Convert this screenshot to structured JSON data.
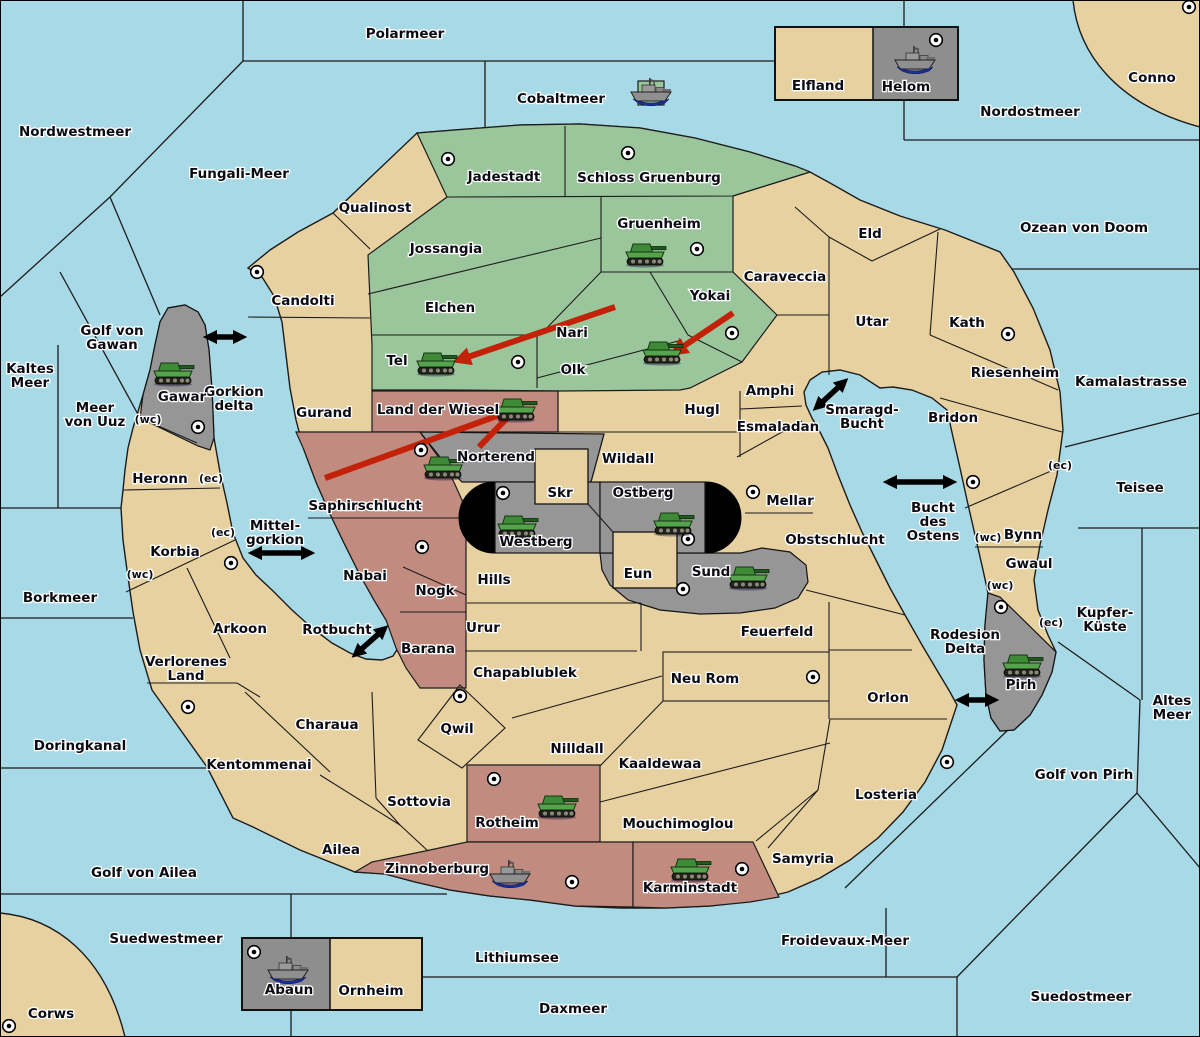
{
  "map": {
    "title": "Strategy war map",
    "colors": {
      "water": "#A8D9E6",
      "land": "#E8D1A0",
      "green_player": "#9BC69B",
      "red_player": "#C28B80",
      "gray_player": "#969696",
      "attack_arrow": "#C32208",
      "connection_arrow": "#000000"
    },
    "seas": [
      {
        "name": "Polarmeer",
        "x": 405,
        "y": 33
      },
      {
        "name": "Nordwestmeer",
        "x": 75,
        "y": 131
      },
      {
        "name": "Fungali-Meer",
        "x": 239,
        "y": 173
      },
      {
        "name": "Cobaltmeer",
        "x": 561,
        "y": 98
      },
      {
        "name": "Nordostmeer",
        "x": 1030,
        "y": 111
      },
      {
        "name": "Ozean von Doom",
        "x": 1084,
        "y": 227
      },
      {
        "name": "Kaltes Meer",
        "x": 30,
        "y": 375,
        "lines": [
          "Kaltes",
          "Meer"
        ]
      },
      {
        "name": "Golf von Gawan",
        "x": 112,
        "y": 337,
        "lines": [
          "Golf von",
          "Gawan"
        ]
      },
      {
        "name": "Meer von Uuz",
        "x": 95,
        "y": 414,
        "lines": [
          "Meer",
          "von Uuz"
        ]
      },
      {
        "name": "Gorkion delta",
        "x": 234,
        "y": 398,
        "lines": [
          "Gorkion",
          "delta"
        ]
      },
      {
        "name": "Kamalastrasse",
        "x": 1131,
        "y": 381
      },
      {
        "name": "Teisee",
        "x": 1140,
        "y": 487
      },
      {
        "name": "Borkmeer",
        "x": 60,
        "y": 597
      },
      {
        "name": "Mittel- gorkion",
        "x": 275,
        "y": 532,
        "lines": [
          "Mittel-",
          "gorkion"
        ]
      },
      {
        "name": "Rotbucht",
        "x": 337,
        "y": 629
      },
      {
        "name": "Smaragd-Bucht",
        "x": 862,
        "y": 416,
        "lines": [
          "Smaragd-",
          "Bucht"
        ]
      },
      {
        "name": "Bucht des Ostens",
        "x": 933,
        "y": 521,
        "lines": [
          "Bucht",
          "des",
          "Ostens"
        ]
      },
      {
        "name": "Kupfer-Küste",
        "x": 1105,
        "y": 619,
        "lines": [
          "Kupfer-",
          "Küste"
        ]
      },
      {
        "name": "Altes Meer",
        "x": 1172,
        "y": 707,
        "lines": [
          "Altes",
          "Meer"
        ]
      },
      {
        "name": "Rodesion Delta",
        "x": 965,
        "y": 641,
        "lines": [
          "Rodesion",
          "Delta"
        ]
      },
      {
        "name": "Golf von Pirh",
        "x": 1084,
        "y": 774
      },
      {
        "name": "Doringkanal",
        "x": 80,
        "y": 745
      },
      {
        "name": "Golf von Ailea",
        "x": 144,
        "y": 872
      },
      {
        "name": "Suedwestmeer",
        "x": 166,
        "y": 938
      },
      {
        "name": "Lithiumsee",
        "x": 517,
        "y": 957
      },
      {
        "name": "Daxmeer",
        "x": 573,
        "y": 1008
      },
      {
        "name": "Froidevaux-Meer",
        "x": 845,
        "y": 940
      },
      {
        "name": "Suedostmeer",
        "x": 1081,
        "y": 996
      }
    ],
    "territories": [
      {
        "name": "Jadestadt",
        "x": 504,
        "y": 176,
        "color": "green"
      },
      {
        "name": "Schloss Gruenburg",
        "x": 649,
        "y": 177,
        "color": "green"
      },
      {
        "name": "Gruenheim",
        "x": 659,
        "y": 223,
        "color": "green"
      },
      {
        "name": "Jossangia",
        "x": 446,
        "y": 248,
        "color": "green"
      },
      {
        "name": "Elchen",
        "x": 450,
        "y": 307,
        "color": "green"
      },
      {
        "name": "Nari",
        "x": 572,
        "y": 332,
        "color": "green"
      },
      {
        "name": "Yokai",
        "x": 710,
        "y": 295,
        "color": "green"
      },
      {
        "name": "Tel",
        "x": 397,
        "y": 360,
        "color": "green"
      },
      {
        "name": "Olk",
        "x": 573,
        "y": 369,
        "color": "green"
      },
      {
        "name": "Qualinost",
        "x": 375,
        "y": 207,
        "color": "tan"
      },
      {
        "name": "Candolti",
        "x": 303,
        "y": 300,
        "color": "tan"
      },
      {
        "name": "Gurand",
        "x": 324,
        "y": 412,
        "color": "tan"
      },
      {
        "name": "Caraveccia",
        "x": 785,
        "y": 276,
        "color": "tan"
      },
      {
        "name": "Eld",
        "x": 870,
        "y": 233,
        "color": "tan"
      },
      {
        "name": "Utar",
        "x": 872,
        "y": 321,
        "color": "tan"
      },
      {
        "name": "Kath",
        "x": 967,
        "y": 322,
        "color": "tan"
      },
      {
        "name": "Riesenheim",
        "x": 1015,
        "y": 372,
        "color": "tan"
      },
      {
        "name": "Bridon",
        "x": 953,
        "y": 417,
        "color": "tan"
      },
      {
        "name": "Amphi",
        "x": 770,
        "y": 390,
        "color": "tan"
      },
      {
        "name": "Esmaladan",
        "x": 778,
        "y": 426,
        "color": "tan"
      },
      {
        "name": "Hugl",
        "x": 702,
        "y": 409,
        "color": "tan"
      },
      {
        "name": "Wildall",
        "x": 628,
        "y": 458,
        "color": "tan"
      },
      {
        "name": "Mellar",
        "x": 790,
        "y": 500,
        "color": "tan"
      },
      {
        "name": "Obstschlucht",
        "x": 835,
        "y": 539,
        "color": "tan"
      },
      {
        "name": "Skr",
        "x": 560,
        "y": 492,
        "color": "tan"
      },
      {
        "name": "Eun",
        "x": 638,
        "y": 573,
        "color": "tan"
      },
      {
        "name": "Hills",
        "x": 494,
        "y": 579,
        "color": "tan"
      },
      {
        "name": "Urur",
        "x": 483,
        "y": 627,
        "color": "tan"
      },
      {
        "name": "Feuerfeld",
        "x": 777,
        "y": 631,
        "color": "tan"
      },
      {
        "name": "Neu Rom",
        "x": 705,
        "y": 678,
        "color": "tan"
      },
      {
        "name": "Chapablublek",
        "x": 525,
        "y": 672,
        "color": "tan"
      },
      {
        "name": "Qwil",
        "x": 457,
        "y": 728,
        "color": "tan"
      },
      {
        "name": "Nilldall",
        "x": 577,
        "y": 748,
        "color": "tan"
      },
      {
        "name": "Kaaldewaa",
        "x": 660,
        "y": 763,
        "color": "tan"
      },
      {
        "name": "Orlon",
        "x": 888,
        "y": 697,
        "color": "tan"
      },
      {
        "name": "Losteria",
        "x": 886,
        "y": 794,
        "color": "tan"
      },
      {
        "name": "Samyria",
        "x": 803,
        "y": 858,
        "color": "tan"
      },
      {
        "name": "Charaua",
        "x": 327,
        "y": 724,
        "color": "tan"
      },
      {
        "name": "Kentommenai",
        "x": 259,
        "y": 764,
        "color": "tan"
      },
      {
        "name": "Arkoon",
        "x": 240,
        "y": 628,
        "color": "tan"
      },
      {
        "name": "Verlorenes Land",
        "x": 186,
        "y": 668,
        "color": "tan",
        "lines": [
          "Verlorenes",
          "Land"
        ]
      },
      {
        "name": "Korbia",
        "x": 175,
        "y": 551,
        "color": "tan"
      },
      {
        "name": "Heronn",
        "x": 160,
        "y": 478,
        "color": "tan"
      },
      {
        "name": "Sottovia",
        "x": 419,
        "y": 801,
        "color": "tan"
      },
      {
        "name": "Ailea",
        "x": 341,
        "y": 849,
        "color": "tan"
      },
      {
        "name": "Mouchimoglou",
        "x": 678,
        "y": 823,
        "color": "tan"
      },
      {
        "name": "Elfland",
        "x": 818,
        "y": 85,
        "color": "tan"
      },
      {
        "name": "Ornheim",
        "x": 371,
        "y": 990,
        "color": "tan"
      },
      {
        "name": "Bynn",
        "x": 1023,
        "y": 534,
        "color": "tan"
      },
      {
        "name": "Gwaul",
        "x": 1029,
        "y": 563,
        "color": "tan"
      },
      {
        "name": "Conno",
        "x": 1152,
        "y": 77,
        "color": "tan"
      },
      {
        "name": "Corws",
        "x": 51,
        "y": 1013,
        "color": "tan"
      },
      {
        "name": "Land der Wiesel",
        "x": 438,
        "y": 409,
        "color": "red"
      },
      {
        "name": "Saphirschlucht",
        "x": 365,
        "y": 505,
        "color": "red"
      },
      {
        "name": "Nabai",
        "x": 365,
        "y": 575,
        "color": "red"
      },
      {
        "name": "Nogk",
        "x": 435,
        "y": 590,
        "color": "red"
      },
      {
        "name": "Barana",
        "x": 428,
        "y": 648,
        "color": "red"
      },
      {
        "name": "Rotheim",
        "x": 507,
        "y": 822,
        "color": "red"
      },
      {
        "name": "Zinnoberburg",
        "x": 437,
        "y": 868,
        "color": "red"
      },
      {
        "name": "Karminstadt",
        "x": 690,
        "y": 887,
        "color": "red"
      },
      {
        "name": "Gawar",
        "x": 182,
        "y": 396,
        "color": "gray"
      },
      {
        "name": "Norterend",
        "x": 496,
        "y": 456,
        "color": "gray"
      },
      {
        "name": "Westberg",
        "x": 536,
        "y": 541,
        "color": "gray"
      },
      {
        "name": "Ostberg",
        "x": 643,
        "y": 492,
        "color": "gray"
      },
      {
        "name": "Sund",
        "x": 711,
        "y": 571,
        "color": "gray"
      },
      {
        "name": "Pirh",
        "x": 1021,
        "y": 684,
        "color": "gray"
      },
      {
        "name": "Helom",
        "x": 906,
        "y": 86,
        "color": "gray"
      },
      {
        "name": "Abaun",
        "x": 289,
        "y": 989,
        "color": "gray"
      }
    ],
    "capitals": [
      [
        448,
        159
      ],
      [
        628,
        153
      ],
      [
        697,
        249
      ],
      [
        732,
        333
      ],
      [
        518,
        362
      ],
      [
        257,
        272
      ],
      [
        198,
        427
      ],
      [
        421,
        450
      ],
      [
        503,
        493
      ],
      [
        688,
        539
      ],
      [
        683,
        589
      ],
      [
        753,
        492
      ],
      [
        973,
        482
      ],
      [
        1008,
        334
      ],
      [
        1189,
        7
      ],
      [
        936,
        40
      ],
      [
        422,
        547
      ],
      [
        231,
        563
      ],
      [
        188,
        707
      ],
      [
        9,
        1026
      ],
      [
        254,
        952
      ],
      [
        460,
        696
      ],
      [
        813,
        677
      ],
      [
        494,
        779
      ],
      [
        572,
        882
      ],
      [
        742,
        869
      ],
      [
        947,
        762
      ],
      [
        1001,
        607
      ]
    ],
    "tanks": [
      [
        645,
        255
      ],
      [
        436,
        364
      ],
      [
        662,
        353
      ],
      [
        173,
        374
      ],
      [
        516,
        410
      ],
      [
        443,
        468
      ],
      [
        517,
        527
      ],
      [
        673,
        524
      ],
      [
        748,
        578
      ],
      [
        1022,
        666
      ],
      [
        557,
        807
      ],
      [
        690,
        870
      ]
    ],
    "ships": [
      {
        "x": 651,
        "y": 92,
        "marker": true
      },
      {
        "x": 915,
        "y": 60
      },
      {
        "x": 288,
        "y": 970
      },
      {
        "x": 510,
        "y": 874
      }
    ],
    "black_arrows": [
      [
        210,
        337,
        240,
        337
      ],
      [
        255,
        553,
        308,
        553
      ],
      [
        357,
        653,
        383,
        630
      ],
      [
        818,
        406,
        843,
        383
      ],
      [
        890,
        482,
        950,
        482
      ],
      [
        962,
        700,
        992,
        700
      ]
    ],
    "red_arrows": [
      {
        "x1": 615,
        "y1": 307,
        "x2": 462,
        "y2": 359,
        "head": true
      },
      {
        "x1": 733,
        "y1": 313,
        "x2": 678,
        "y2": 350,
        "head": true
      },
      {
        "x1": 325,
        "y1": 478,
        "x2": 505,
        "y2": 413,
        "head": true
      },
      {
        "x1": 479,
        "y1": 447,
        "x2": 509,
        "y2": 416,
        "head": false
      }
    ],
    "coast_markers": [
      {
        "text": "(wc)",
        "x": 148,
        "y": 419
      },
      {
        "text": "(ec)",
        "x": 211,
        "y": 478
      },
      {
        "text": "(ec)",
        "x": 223,
        "y": 532
      },
      {
        "text": "(wc)",
        "x": 140,
        "y": 574
      },
      {
        "text": "(ec)",
        "x": 1060,
        "y": 465
      },
      {
        "text": "(wc)",
        "x": 988,
        "y": 537
      },
      {
        "text": "(wc)",
        "x": 1000,
        "y": 585
      },
      {
        "text": "(ec)",
        "x": 1051,
        "y": 622
      }
    ]
  }
}
